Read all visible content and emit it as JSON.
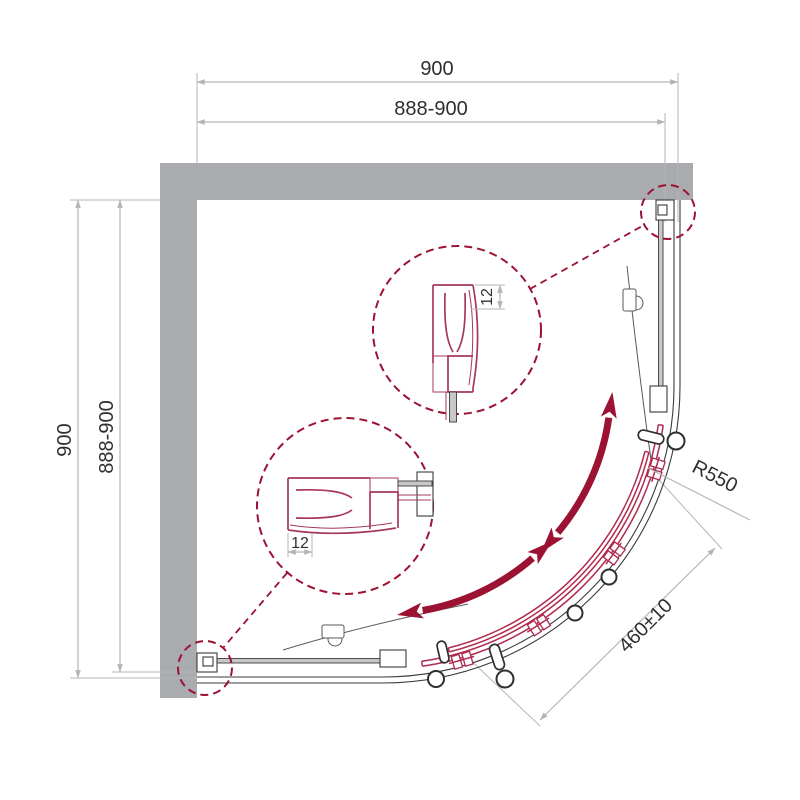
{
  "drawing": {
    "type": "shower-enclosure-quarter-round-plan",
    "dims": {
      "top_overall": "900",
      "top_range": "888-900",
      "side_overall": "900",
      "side_range": "888-900",
      "radius": "R550",
      "opening": "460±10",
      "detail_top_thickness": "12",
      "detail_bottom_thickness": "12"
    },
    "colors": {
      "wall": "#a9abae",
      "line": "#3b3b3d",
      "dimension": "#b3b6b8",
      "text": "#2f2f31",
      "accent": "#9b1232",
      "detail": "#a5395a",
      "glass": "#c6c8ca",
      "background": "#ffffff"
    }
  }
}
